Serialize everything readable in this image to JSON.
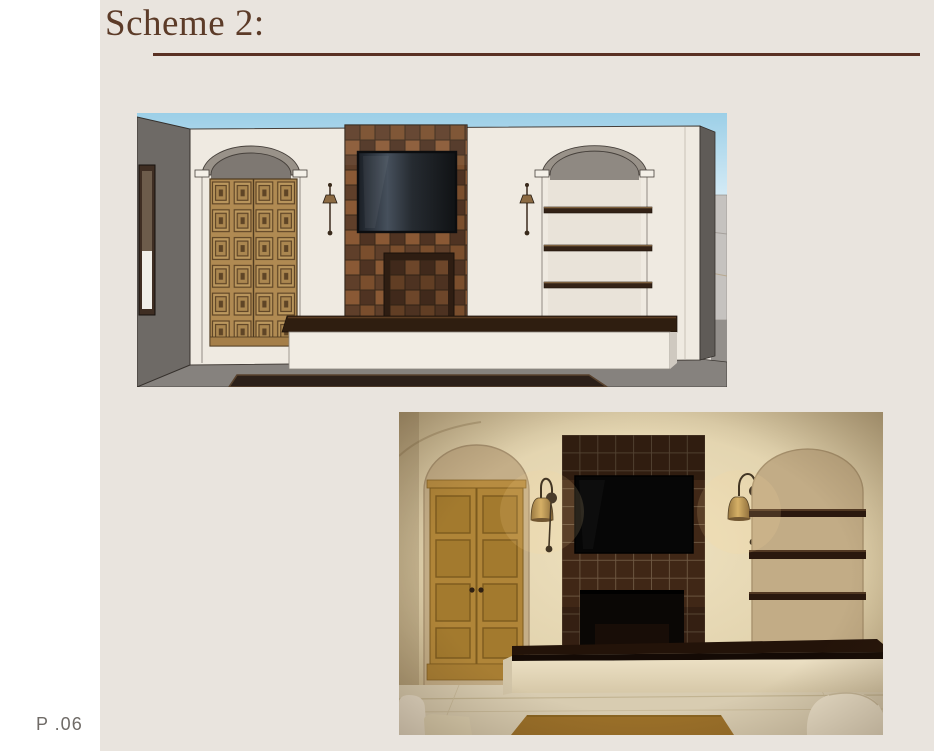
{
  "header": {
    "title": "Scheme 2:"
  },
  "footer": {
    "page_number": "P .06"
  },
  "figures": [
    {
      "name": "sketchup-elevation-render",
      "description": "3D elevation rendering: arched niche with carved wood door, brown tile fireplace wall with mounted TV and firebox, wall sconces, arched shelving niche, long plaster bench hearth"
    },
    {
      "name": "photorealistic-render",
      "description": "Photorealistic rendering of same wall: ochre wood cabinet in arched niche, dark glazed tile fireplace with TV, brass bell sconces, arched niche with dark wood shelves, plaster bench with dark wood top"
    }
  ],
  "colors": {
    "page_background": "#e9e4de",
    "margin_strip": "#ffffff",
    "title_brown": "#5c3b28",
    "rule_brown": "#5a3124",
    "page_number_gray": "#6f6b67"
  }
}
